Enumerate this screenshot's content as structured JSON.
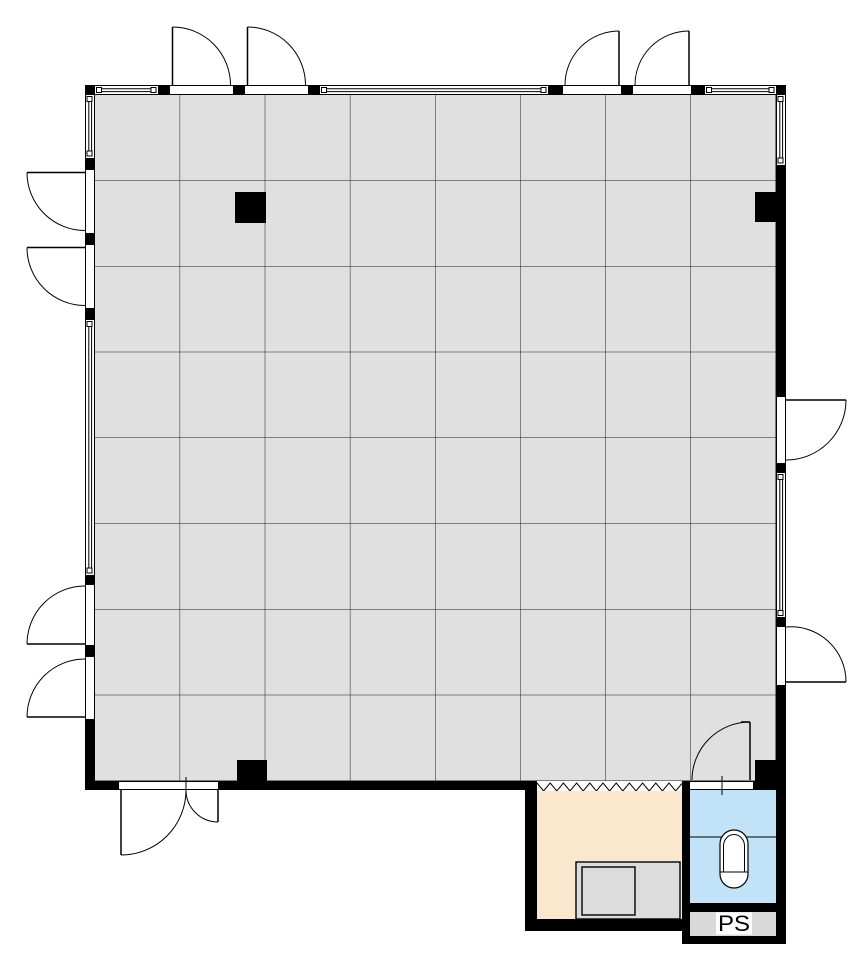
{
  "meta": {
    "type": "architectural-floor-plan",
    "description": "Single large tiled hall with perimeter window walls, out-swinging double doors on three sides, four structural columns, a service annex with counter, a toilet room with squat toilet, and a pipe shaft compartment."
  },
  "labels": {
    "pipe_shaft": "PS"
  },
  "colors": {
    "wall": "#000000",
    "line": "#000000",
    "floor_tile": "#E0E0E0",
    "tile_joint": "#1A1A1A",
    "annex_floor": "#FAE7CE",
    "toilet_floor": "#C2E2F8",
    "counter_outer": "#DCDCDC",
    "counter_inner": "#DCDCDC",
    "ps_floor": "#D9D9D9",
    "fixture_fill": "#FFFFFF",
    "paper": "#FFFFFF"
  },
  "grid": {
    "columns": 8,
    "rows": 8
  },
  "rooms": [
    {
      "name": "main-hall",
      "floor": "tile-grid",
      "fill_key": "floor_tile"
    },
    {
      "name": "service-annex",
      "floor": "plain",
      "fill_key": "annex_floor"
    },
    {
      "name": "toilet-room",
      "floor": "plain",
      "fill_key": "toilet_floor",
      "fixture": "squat-toilet"
    },
    {
      "name": "pipe-shaft",
      "label": "PS",
      "fill_key": "ps_floor"
    }
  ],
  "openings": {
    "door_leaves": 13,
    "window_segments": 7,
    "notes": "double out-swing doors top-left, top-right, left-upper, left-lower; single doors right wall; unequal double entrance door bottom; toilet door; zigzag break line between hall and annex"
  }
}
